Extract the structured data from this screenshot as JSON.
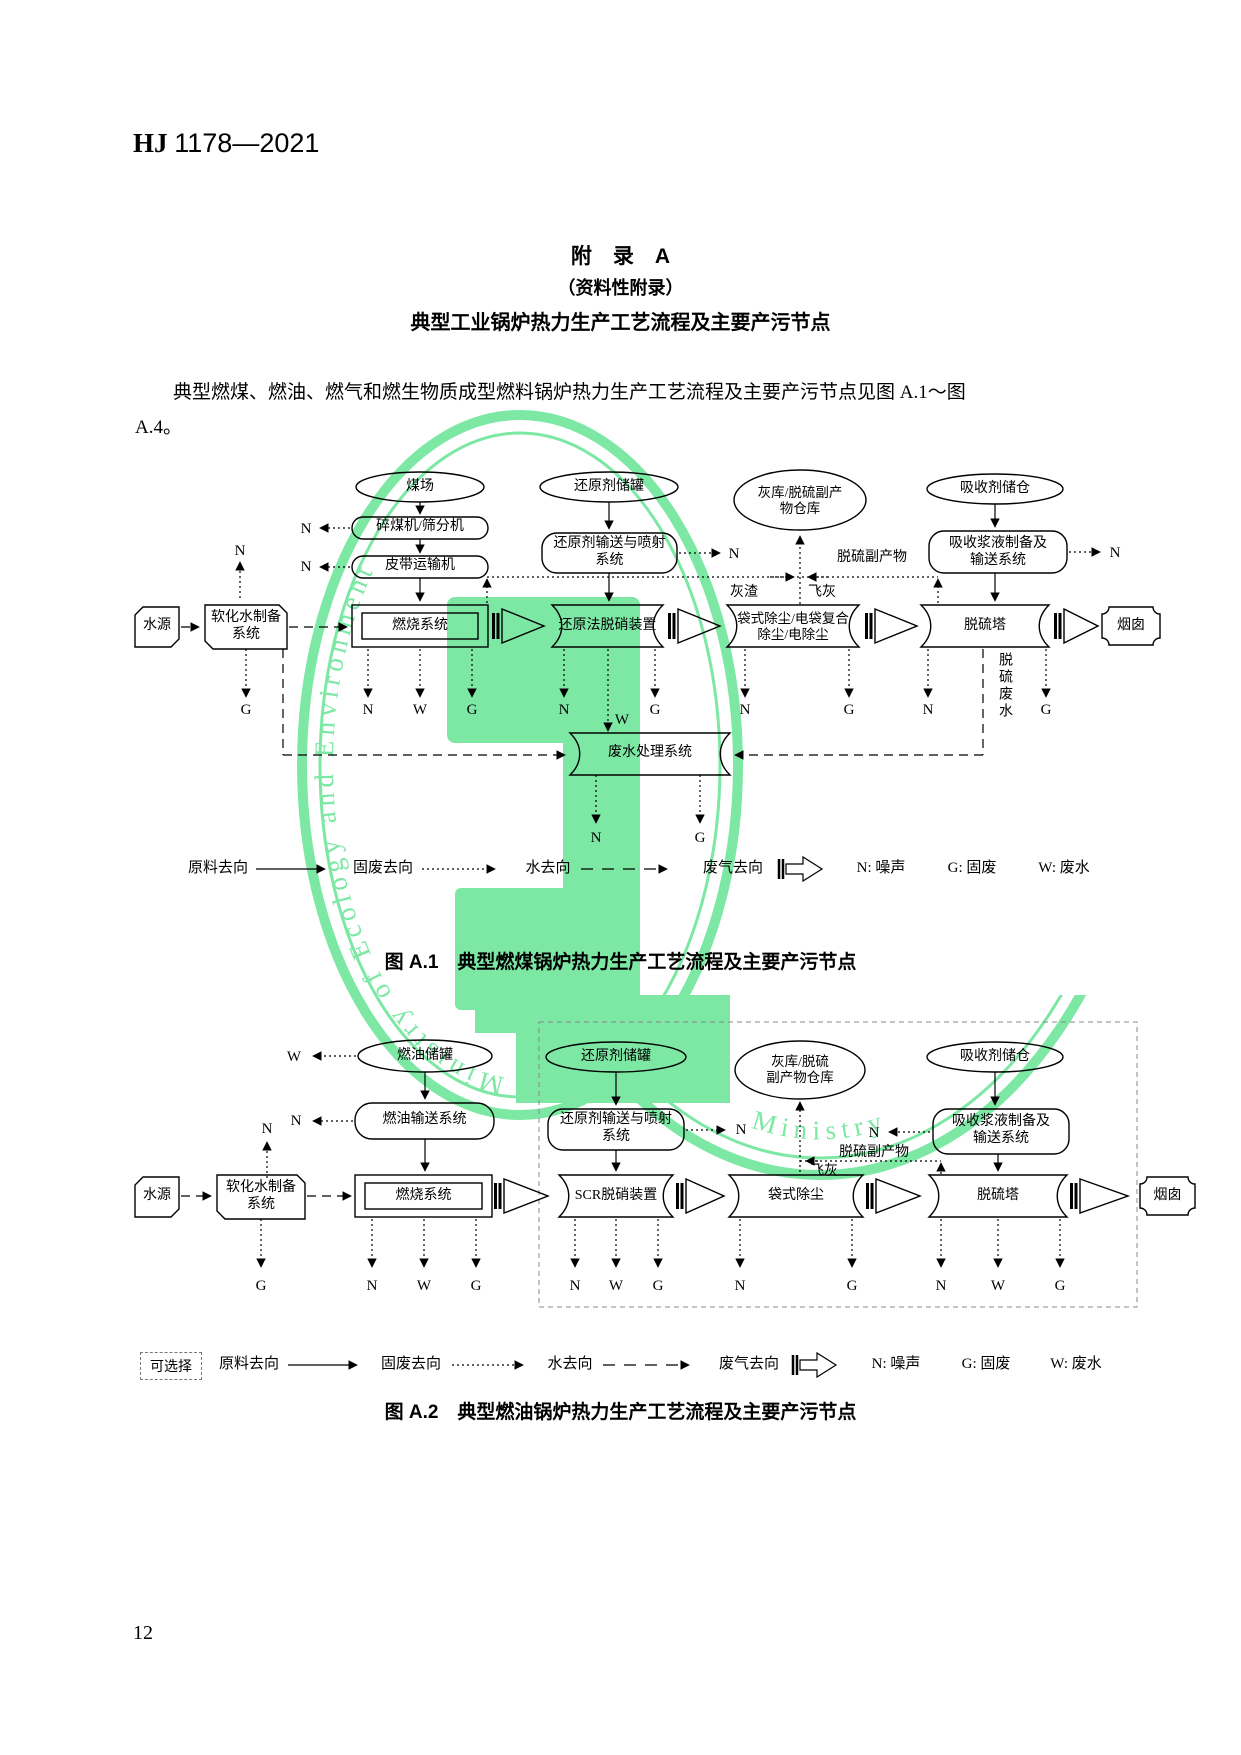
{
  "page": {
    "code_label": "HJ",
    "code_number": "1178—2021",
    "page_number": "12"
  },
  "appendix": {
    "title": "附　录　A",
    "subtitle": "（资料性附录）",
    "heading": "典型工业锅炉热力生产工艺流程及主要产污节点",
    "intro_line1": "典型燃煤、燃油、燃气和燃生物质成型燃料锅炉热力生产工艺流程及主要产污节点见图 A.1～图",
    "intro_line2": "A.4。"
  },
  "watermark": {
    "color": "#7ce8a4",
    "ring1_text": "Ministry of Ecology and Environment",
    "ring2_text": "Ministry"
  },
  "letters": {
    "n": "N",
    "g": "G",
    "w": "W"
  },
  "legend": {
    "optional": "可选择",
    "raw_material": "原料去向",
    "solid_waste": "固废去向",
    "water": "水去向",
    "exhaust": "废气去向",
    "noise_key": "N: 噪声",
    "solid_key": "G: 固废",
    "wastewater_key": "W: 废水"
  },
  "fig_a1": {
    "caption": "图 A.1　典型燃煤锅炉热力生产工艺流程及主要产污节点",
    "coal_yard": "煤场",
    "crusher": "碎煤机/筛分机",
    "belt": "皮带运输机",
    "reductant_tank": "还原剂储罐",
    "reductant_sys1": "还原剂输送与喷射",
    "reductant_sys2": "系统",
    "ash_store1": "灰库/脱硫副产",
    "ash_store2": "物仓库",
    "absorbent_silo": "吸收剂储仓",
    "slurry1": "吸收浆液制备及",
    "slurry2": "输送系统",
    "water_source": "水源",
    "soft_water1": "软化水制备",
    "soft_water2": "系统",
    "combustion": "燃烧系统",
    "denitration": "还原法脱硝装置",
    "dust1": "袋式除尘/电袋复合",
    "dust2": "除尘/电除尘",
    "tower": "脱硫塔",
    "chimney": "烟囱",
    "wastewater_sys": "废水处理系统",
    "byproduct": "脱硫副产物",
    "bottom_ash": "灰渣",
    "fly_ash": "飞灰",
    "desulf_wastewater": "脱硫废水"
  },
  "fig_a2": {
    "caption": "图 A.2　典型燃油锅炉热力生产工艺流程及主要产污节点",
    "oil_tank": "燃油储罐",
    "oil_transfer": "燃油输送系统",
    "reductant_tank": "还原剂储罐",
    "reductant_sys1": "还原剂输送与喷射",
    "reductant_sys2": "系统",
    "ash_store1": "灰库/脱硫",
    "ash_store2": "副产物仓库",
    "absorbent_silo": "吸收剂储仓",
    "slurry1": "吸收浆液制备及",
    "slurry2": "输送系统",
    "water_source": "水源",
    "soft_water1": "软化水制备",
    "soft_water2": "系统",
    "combustion": "燃烧系统",
    "scr": "SCR脱硝装置",
    "dust": "袋式除尘",
    "tower": "脱硫塔",
    "chimney": "烟囱",
    "byproduct": "脱硫副产物",
    "fly_ash": "飞灰"
  }
}
